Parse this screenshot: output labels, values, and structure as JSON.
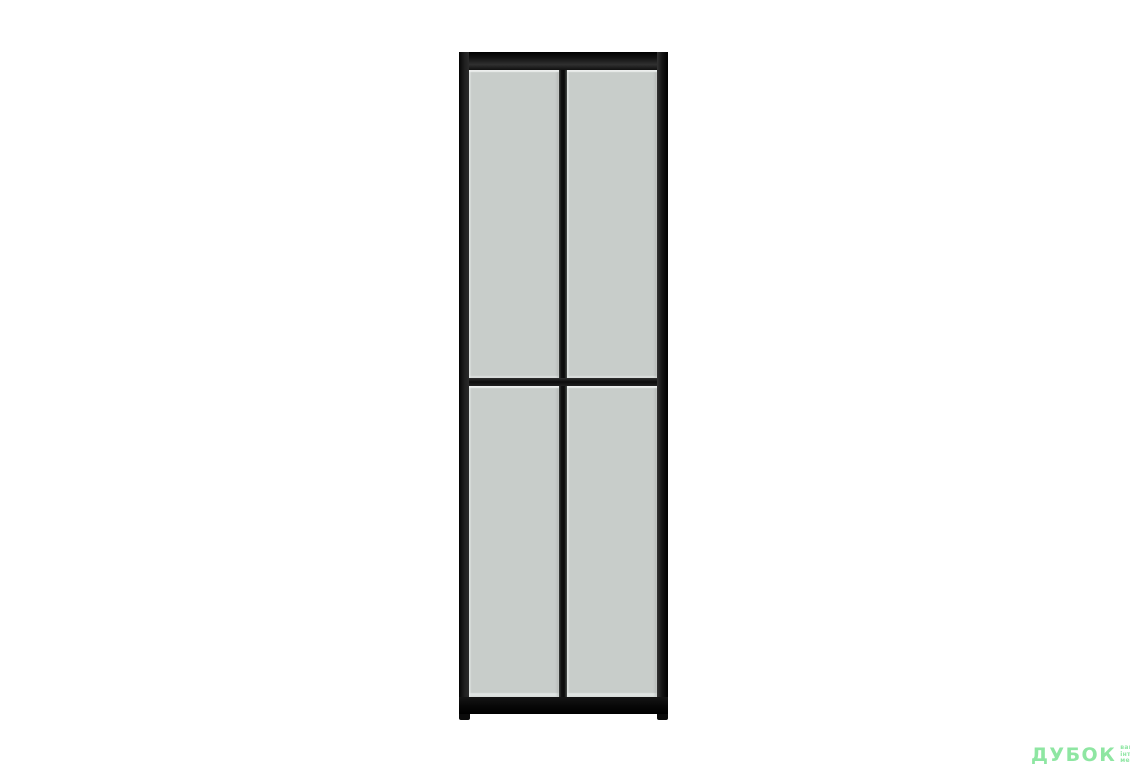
{
  "scene": {
    "background_color": "#ffffff"
  },
  "product": {
    "kind": "tall-two-door-glass-cabinet",
    "frame_color": "#1b1b1b",
    "glass_color": "#c8cdca",
    "glass_highlight_color": "#e8ebe9",
    "door_count": "2",
    "panel_rows": "2",
    "panel_count": "4"
  },
  "watermark": {
    "logo_text": "ДУБОК",
    "tagline_line1": "ваша",
    "tagline_line2": "інтернет",
    "tagline_line3": "меблі",
    "color": "#8ee6a2"
  }
}
